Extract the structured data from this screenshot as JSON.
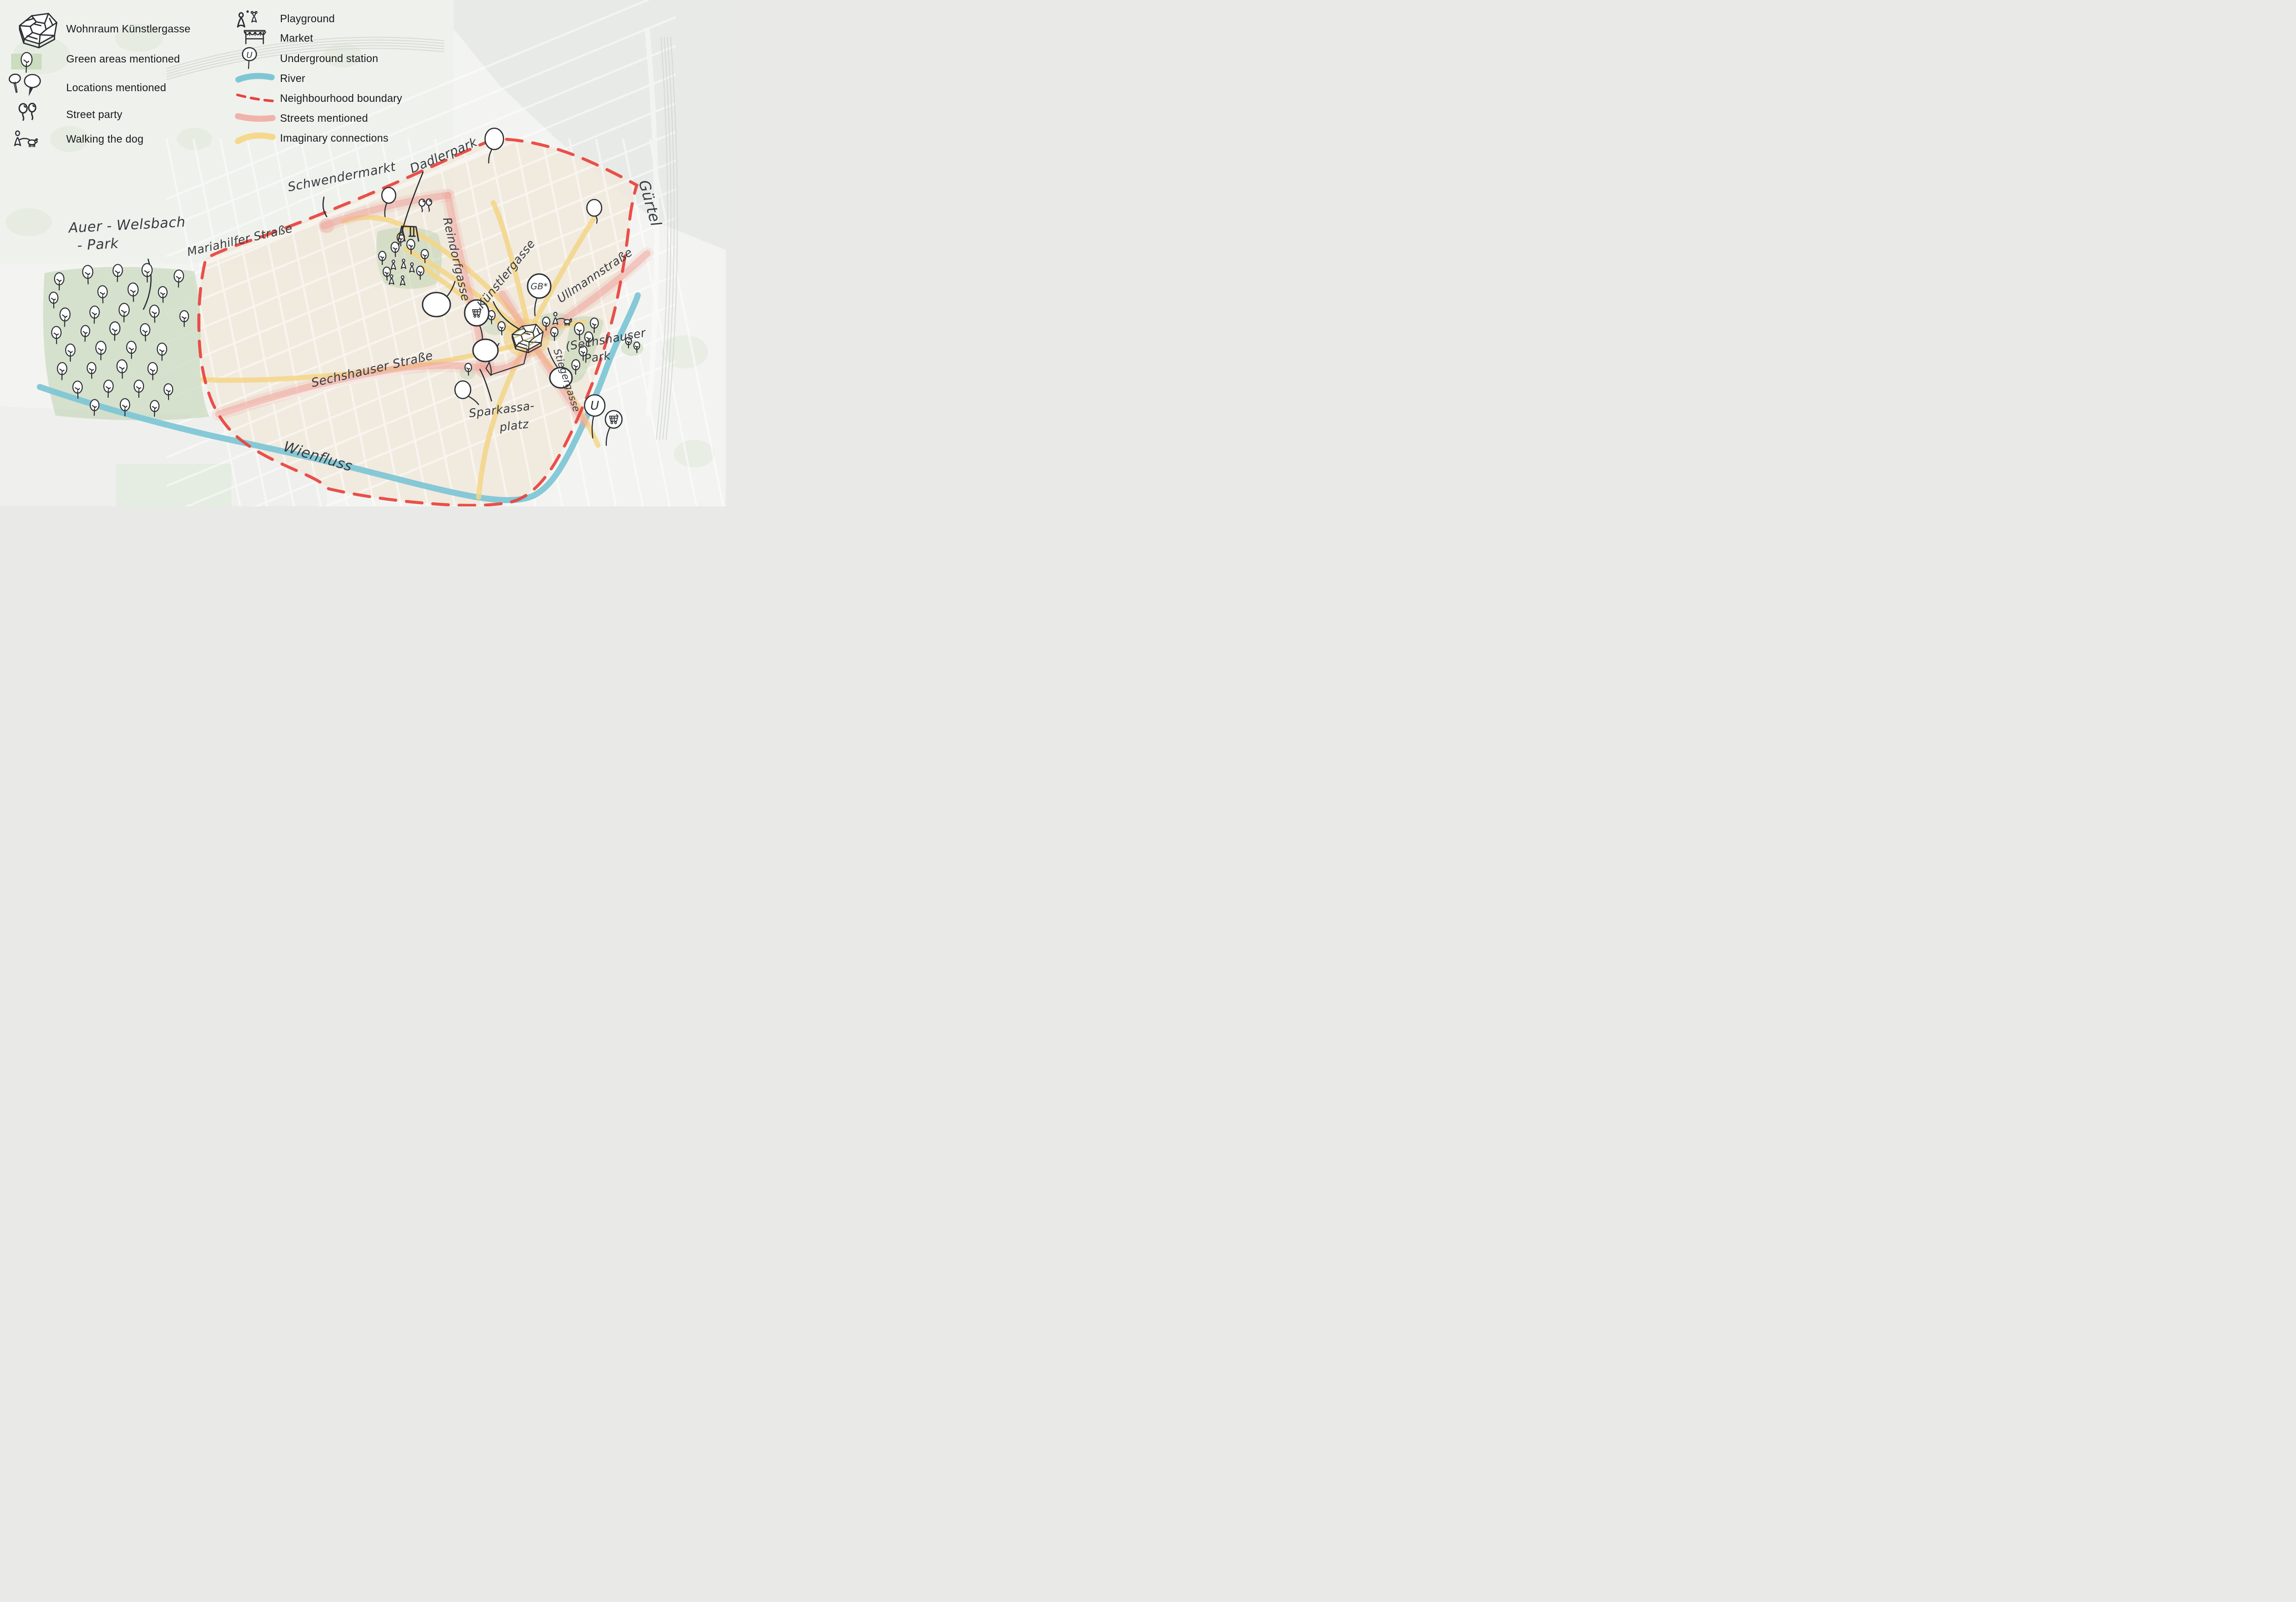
{
  "legend": {
    "column1": [
      {
        "id": "wohnraum",
        "icon": "building",
        "label": "Wohnraum Künstlergasse"
      },
      {
        "id": "green-areas",
        "icon": "green-tree",
        "label": "Green areas mentioned"
      },
      {
        "id": "locations",
        "icon": "location-pins",
        "label": "Locations mentioned"
      },
      {
        "id": "street-party",
        "icon": "party-balloons",
        "label": "Street party"
      },
      {
        "id": "walking-dog",
        "icon": "dog-walk",
        "label": "Walking the dog"
      }
    ],
    "column2": [
      {
        "id": "playground",
        "icon": "playground",
        "label": "Playground"
      },
      {
        "id": "market",
        "icon": "market",
        "label": "Market"
      },
      {
        "id": "underground",
        "icon": "u-pin",
        "label": "Underground station"
      },
      {
        "id": "river",
        "icon": "river-swatch",
        "label": "River"
      },
      {
        "id": "boundary",
        "icon": "boundary-swatch",
        "label": "Neighbourhood boundary"
      },
      {
        "id": "streets",
        "icon": "street-swatch",
        "label": "Streets mentioned"
      },
      {
        "id": "connections",
        "icon": "connection-swatch",
        "label": "Imaginary connections"
      }
    ]
  },
  "map_labels": {
    "auer1": "Auer - Welsbach",
    "auer2": "- Park",
    "mariahilfer": "Mariahilfer Straße",
    "schwendermarkt": "Schwendermarkt",
    "dadlerpark": "Dadlerpark",
    "reindorfgasse": "Reindorfgasse",
    "kuenstlergasse": "Künstlergasse",
    "ullmannstrasse": "Ullmannstraße",
    "sechshauserpark1": "(Sechshauser",
    "sechshauserpark2": "Park",
    "stiegergasse": "Stiegergasse",
    "sechshauserstrasse": "Sechshauser Straße",
    "sparkassa1": "Sparkassa-",
    "sparkassa2": "platz",
    "wienfluss": "Wienfluss",
    "guertel": "Gürtel"
  },
  "markers": {
    "gb_pin_label": "GB*",
    "u_pin_label": "U"
  },
  "colors": {
    "river": "#7fc6d5",
    "boundary": "#e8413c",
    "streets_mentioned": "#efa49b",
    "imaginary_connections": "#f4d687",
    "green_area": "#bcd2ae",
    "ink": "#2c2f33",
    "handwriting": "#383c40",
    "building_highlight": "#f0d07c"
  }
}
